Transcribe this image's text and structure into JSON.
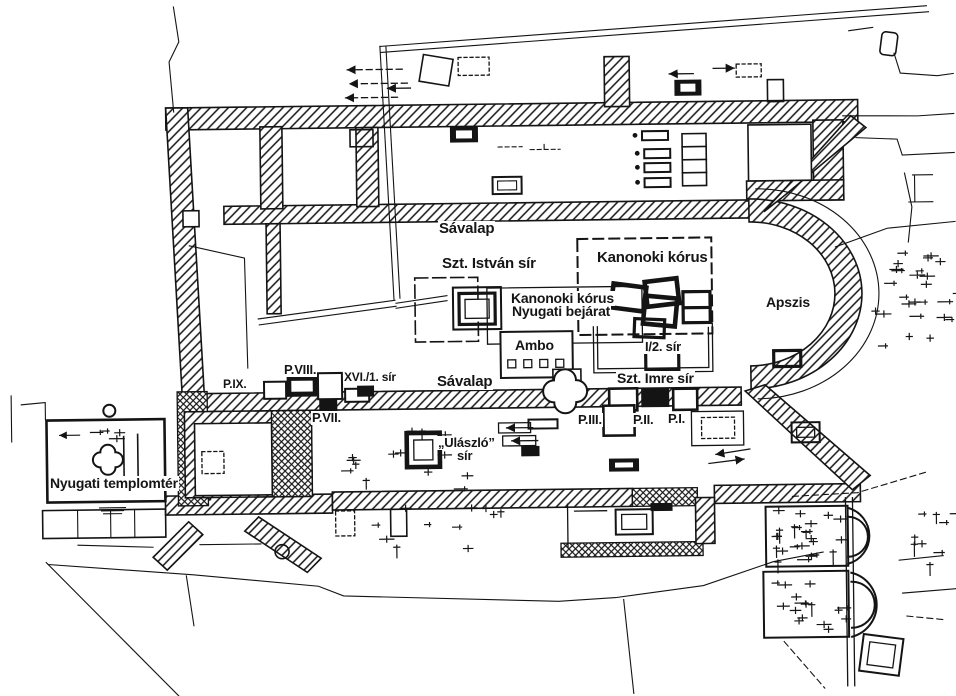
{
  "meta": {
    "title": "Basilica excavation ground plan",
    "language": "Hungarian",
    "ink_color": "#141414",
    "paper_color": "#ffffff"
  },
  "labels": {
    "savalap_north": "Sávalap",
    "szt_istvan_sir": "Szt. István sír",
    "kanonoki_korus": "Kanonoki kórus",
    "kanonoki_korus_bejarat_1": "Kanonoki kórus",
    "kanonoki_korus_bejarat_2": "Nyugati bejárat",
    "apszis": "Apszis",
    "ambo": "Ambo",
    "i2_sir": "I/2. sír",
    "savalap_south": "Sávalap",
    "szt_imre_sir": "Szt. Imre sír",
    "p_ix": "P.IX.",
    "p_viii": "P.VIII.",
    "xvi_1_sir": "XVI./1. sír",
    "p_vii": "P.VII.",
    "ulaszlo_sir_1": "„Ulászló”",
    "ulaszlo_sir_2": "sír",
    "p_iii": "P.III.",
    "p_ii": "P.II.",
    "p_i": "P.I.",
    "nyugati_templomter": "Nyugati templomtér"
  }
}
